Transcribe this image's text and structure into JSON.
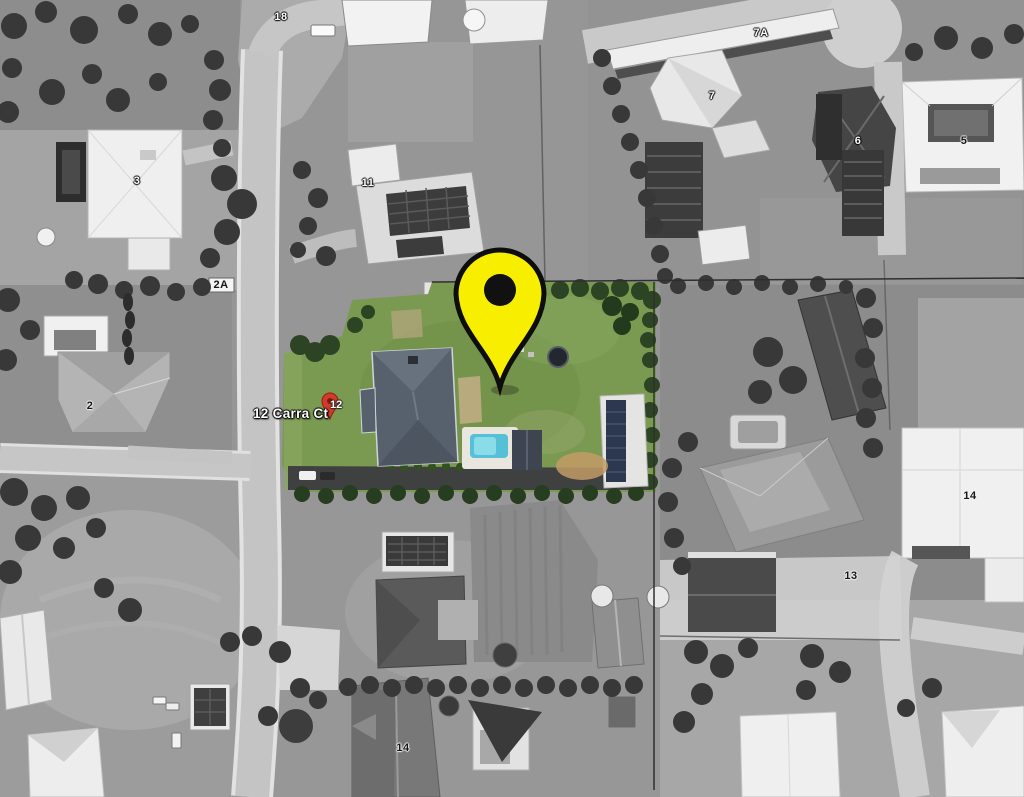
{
  "map": {
    "view_type": "black-and-white aerial photograph with one property highlighted in colour",
    "address_label": {
      "text": "12 Carra Ct",
      "pin_number": "12"
    },
    "selected_marker": {
      "name": "selected-property-pin",
      "shape": "teardrop-pin",
      "fill": "#f8ee00",
      "outline": "#0d0d0d",
      "hole": "#111111",
      "tip": {
        "x": 499,
        "y": 387
      }
    },
    "mini_marker": {
      "fill": "#d43a2a",
      "x": 330,
      "y": 410
    },
    "house_numbers": [
      {
        "id": "18",
        "label": "18",
        "x": 281,
        "y": 17,
        "style": "light"
      },
      {
        "id": "3",
        "label": "3",
        "x": 137,
        "y": 181,
        "style": "light"
      },
      {
        "id": "2A",
        "label": "2A",
        "x": 221,
        "y": 285,
        "style": "dark"
      },
      {
        "id": "2",
        "label": "2",
        "x": 90,
        "y": 406,
        "style": "dark"
      },
      {
        "id": "11",
        "label": "11",
        "x": 368,
        "y": 183,
        "style": "light"
      },
      {
        "id": "7A",
        "label": "7A",
        "x": 761,
        "y": 33,
        "style": "light"
      },
      {
        "id": "7",
        "label": "7",
        "x": 712,
        "y": 96,
        "style": "light"
      },
      {
        "id": "6",
        "label": "6",
        "x": 858,
        "y": 141,
        "style": "light"
      },
      {
        "id": "5",
        "label": "5",
        "x": 964,
        "y": 141,
        "style": "dark"
      },
      {
        "id": "14-right",
        "label": "14",
        "x": 970,
        "y": 496,
        "style": "dark"
      },
      {
        "id": "13",
        "label": "13",
        "x": 851,
        "y": 576,
        "style": "dark"
      },
      {
        "id": "14-bottom",
        "label": "14",
        "x": 403,
        "y": 748,
        "style": "dark"
      }
    ],
    "highlight_colors": {
      "lawn": "#7a9a52",
      "trees": "#2c4423",
      "pool_water": "#55c0d6",
      "house_roof": "#57616d",
      "driveway": "#3f4040",
      "sand": "#c29b66"
    },
    "grayscale_palette": {
      "field": "#959595",
      "road": "#c6c6c6",
      "building_light": "#f0f0f0",
      "roof_dark": "#474747",
      "tree": "#383838"
    }
  }
}
